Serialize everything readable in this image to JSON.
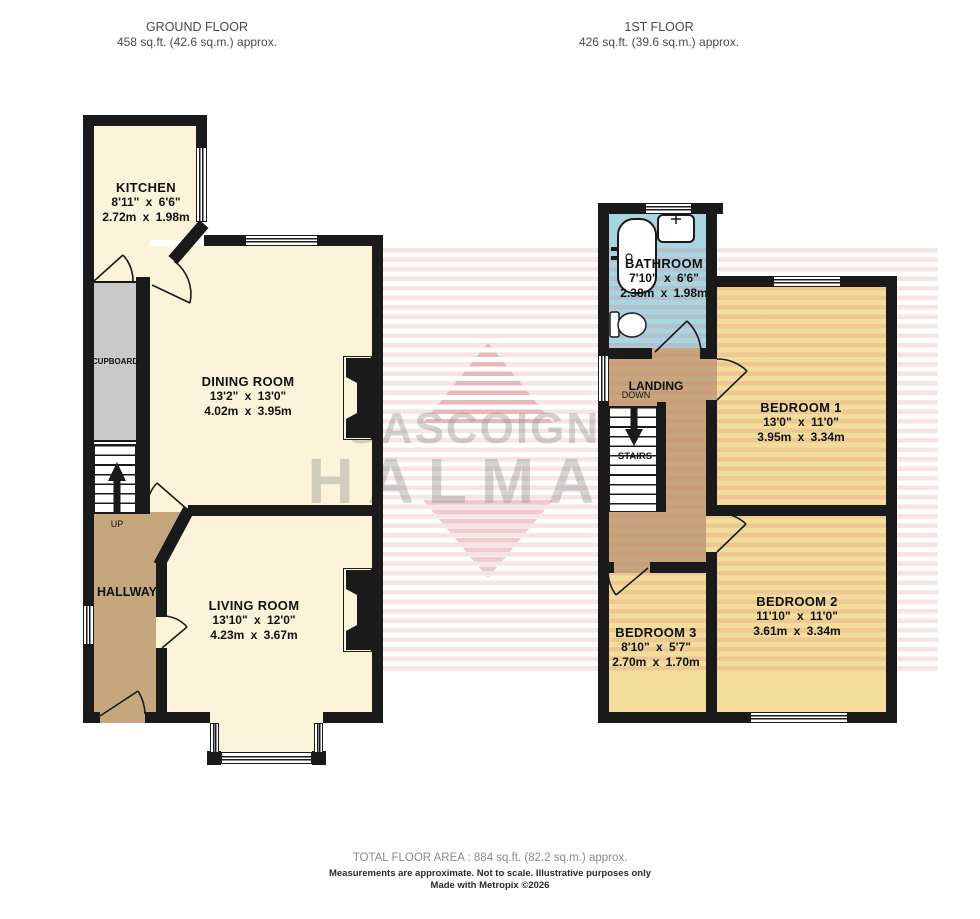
{
  "headers": {
    "ground": {
      "title": "GROUND FLOOR",
      "area": "458 sq.ft. (42.6 sq.m.) approx."
    },
    "first": {
      "title": "1ST FLOOR",
      "area": "426 sq.ft. (39.6 sq.m.) approx."
    }
  },
  "rooms": {
    "kitchen": {
      "name": "KITCHEN",
      "imperial": "8'11\" x 6'6\"",
      "metric": "2.72m x 1.98m"
    },
    "dining": {
      "name": "DINING ROOM",
      "imperial": "13'2\" x 13'0\"",
      "metric": "4.02m x 3.95m"
    },
    "living": {
      "name": "LIVING ROOM",
      "imperial": "13'10\" x 12'0\"",
      "metric": "4.23m x 3.67m"
    },
    "hallway": {
      "name": "HALLWAY"
    },
    "cupboard": {
      "name": "CUPBOARD"
    },
    "bathroom": {
      "name": "BATHROOM",
      "imperial": "7'10\" x 6'6\"",
      "metric": "2.38m x 1.98m"
    },
    "landing": {
      "name": "LANDING"
    },
    "stairs": {
      "name": "STAIRS"
    },
    "bedroom1": {
      "name": "BEDROOM 1",
      "imperial": "13'0\" x 11'0\"",
      "metric": "3.95m x 3.34m"
    },
    "bedroom2": {
      "name": "BEDROOM 2",
      "imperial": "11'10\" x 11'0\"",
      "metric": "3.61m x 3.34m"
    },
    "bedroom3": {
      "name": "BEDROOM 3",
      "imperial": "8'10\" x 5'7\"",
      "metric": "2.70m x 1.70m"
    }
  },
  "stair_labels": {
    "up": "UP",
    "down": "DOWN"
  },
  "watermark": {
    "line1": "GASCOIGNE",
    "line2": "HALMAN"
  },
  "footer": {
    "total": "TOTAL FLOOR AREA : 884 sq.ft. (82.2 sq.m.) approx.",
    "disclaimer": "Measurements are approximate.  Not to scale.  Illustrative purposes only",
    "credit": "Made with Metropix ©2026"
  },
  "colors": {
    "room_cream": "#FBF4DA",
    "bedroom_yellow": "#F3DD9B",
    "hall_tan": "#C6A77D",
    "bathroom_blue": "#A9D4E2",
    "cupboard_gray": "#C9C9C9",
    "wall_black": "#1A1A1A",
    "watermark_pink": "#D67676",
    "watermark_gray": "#969696"
  }
}
